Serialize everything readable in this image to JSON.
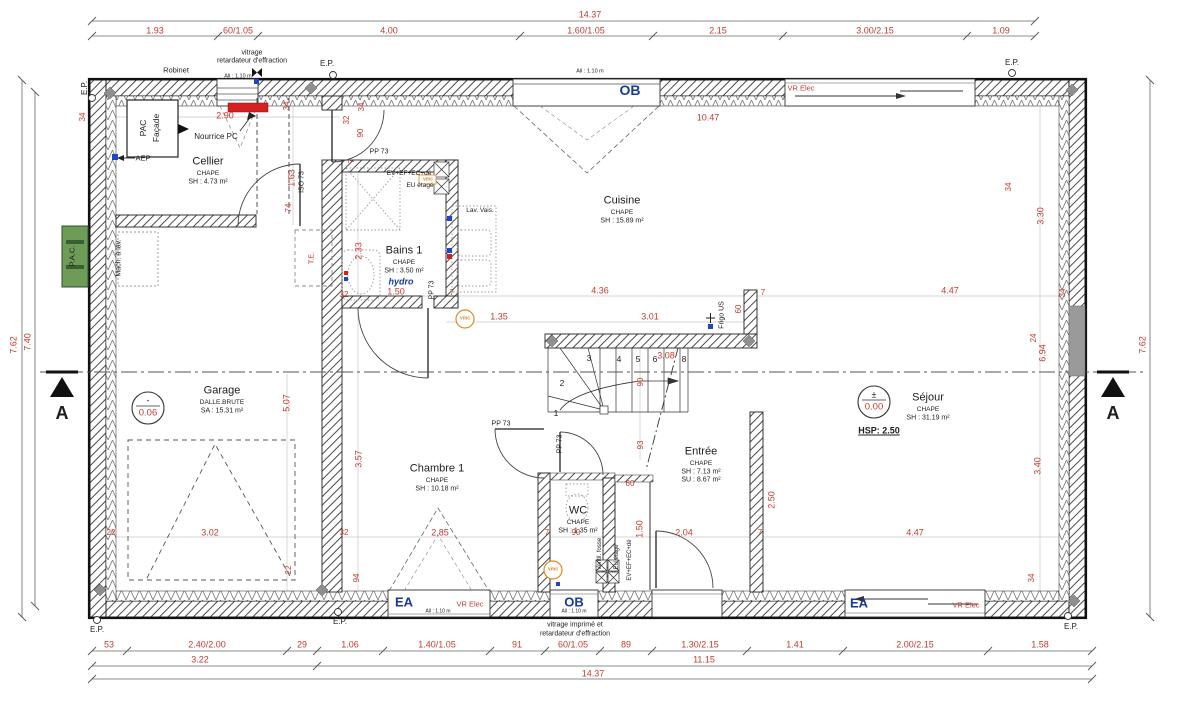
{
  "drawing_type": "floor-plan",
  "colors": {
    "dimension_red": "#c43a30",
    "window_label_blue": "#16399c",
    "vmc_orange": "#e0891e",
    "pac_green": "#6d9c57",
    "nourrice_red_fill": "#d42020",
    "wall_black": "#1d1d1d",
    "concrete_gray": "#9a9a9a"
  },
  "rooms": [
    {
      "name": "Cellier",
      "finish": "CHAPE",
      "area": "SH : 4.73 m²",
      "x": 208,
      "y": 162
    },
    {
      "name": "Bains 1",
      "finish": "CHAPE",
      "area": "SH : 3.50 m²",
      "extra": "hydro",
      "x": 404,
      "y": 251
    },
    {
      "name": "Cuisine",
      "finish": "CHAPE",
      "area": "SH : 15.89 m²",
      "x": 622,
      "y": 201
    },
    {
      "name": "Garage",
      "finish": "DALLE.BRUTE",
      "area": "SA : 15.31 m²",
      "x": 222,
      "y": 391
    },
    {
      "name": "Chambre 1",
      "finish": "CHAPE",
      "area": "SH : 10.18 m²",
      "x": 437,
      "y": 469
    },
    {
      "name": "WC",
      "finish": "CHAPE",
      "area": "SH : 1.35 m²",
      "x": 578,
      "y": 511
    },
    {
      "name": "Entrée",
      "finish": "CHAPE",
      "area": "SH : 7.13 m²",
      "area2": "SU : 8.67 m²",
      "x": 701,
      "y": 452
    },
    {
      "name": "Séjour",
      "finish": "CHAPE",
      "area": "SH : 31.19 m²",
      "x": 928,
      "y": 398
    }
  ],
  "levels": [
    {
      "room": "Garage",
      "sign": "-",
      "value": "0.06"
    },
    {
      "room": "Séjour",
      "sign": "±",
      "value": "0.00"
    }
  ],
  "height_note": "HSP: 2.50",
  "section_marker": "A",
  "stair_numbers": [
    "1",
    "2",
    "3",
    "4",
    "5",
    "6",
    "8"
  ],
  "dim_chains": {
    "h": [
      {
        "y": 21,
        "x": [
          92,
          1035
        ]
      },
      {
        "y": 36,
        "x": [
          92,
          218,
          258,
          520,
          653,
          783,
          967,
          1035
        ]
      },
      {
        "y": 651,
        "x": [
          92,
          127,
          287,
          317,
          383,
          490,
          545,
          600,
          652,
          747,
          843,
          988,
          1092
        ]
      },
      {
        "y": 666,
        "x": [
          92,
          317,
          1092
        ]
      },
      {
        "y": 679,
        "x": [
          92,
          1092
        ]
      }
    ],
    "v": [
      {
        "x": 22,
        "y": [
          80,
          617
        ]
      },
      {
        "x": 35,
        "y": [
          92,
          606
        ]
      },
      {
        "x": 1150,
        "y": [
          80,
          617
        ]
      }
    ]
  },
  "annotations": [
    {
      "t": "14.37",
      "x": 590,
      "y": 15,
      "n": "dim-top-total"
    },
    {
      "t": "1.93",
      "x": 155,
      "y": 31
    },
    {
      "t": "60/1.05",
      "x": 238,
      "y": 31
    },
    {
      "t": "4.00",
      "x": 389,
      "y": 31
    },
    {
      "t": "1.60/1.05",
      "x": 586,
      "y": 31
    },
    {
      "t": "2.15",
      "x": 718,
      "y": 31
    },
    {
      "t": "3.00/2.15",
      "x": 875,
      "y": 31
    },
    {
      "t": "1.09",
      "x": 1001,
      "y": 31
    },
    {
      "t": "53",
      "x": 109,
      "y": 645
    },
    {
      "t": "2.40/2.00",
      "x": 207,
      "y": 645
    },
    {
      "t": "29",
      "x": 302,
      "y": 645
    },
    {
      "t": "1.06",
      "x": 350,
      "y": 645
    },
    {
      "t": "1.40/1.05",
      "x": 437,
      "y": 645
    },
    {
      "t": "91",
      "x": 517,
      "y": 645
    },
    {
      "t": "60/1.05",
      "x": 573,
      "y": 645
    },
    {
      "t": "89",
      "x": 626,
      "y": 645
    },
    {
      "t": "1.30/2.15",
      "x": 700,
      "y": 645
    },
    {
      "t": "1.41",
      "x": 795,
      "y": 645
    },
    {
      "t": "2.00/2.15",
      "x": 915,
      "y": 645
    },
    {
      "t": "1.58",
      "x": 1040,
      "y": 645
    },
    {
      "t": "3.22",
      "x": 200,
      "y": 660
    },
    {
      "t": "11.15",
      "x": 704,
      "y": 660
    },
    {
      "t": "14.37",
      "x": 593,
      "y": 674,
      "n": "dim-bottom-total"
    },
    {
      "t": "7.62",
      "x": 14,
      "y": 345,
      "r": -90
    },
    {
      "t": "7.40",
      "x": 28,
      "y": 342,
      "r": -90
    },
    {
      "t": "7.62",
      "x": 1143,
      "y": 345,
      "r": -90
    },
    {
      "t": "2.90",
      "x": 225,
      "y": 116
    },
    {
      "t": "34",
      "x": 83,
      "y": 117,
      "r": -90,
      "s": 8
    },
    {
      "t": "34",
      "x": 287,
      "y": 106,
      "r": -90,
      "s": 8
    },
    {
      "t": "32",
      "x": 347,
      "y": 120,
      "r": -90,
      "s": 8
    },
    {
      "t": "34",
      "x": 362,
      "y": 107,
      "r": -90,
      "s": 8
    },
    {
      "t": "90",
      "x": 361,
      "y": 133,
      "r": -90,
      "s": 8
    },
    {
      "t": "1.63",
      "x": 292,
      "y": 178,
      "r": -90
    },
    {
      "t": "74",
      "x": 289,
      "y": 208,
      "r": -90,
      "s": 8
    },
    {
      "t": "10.47",
      "x": 708,
      "y": 118
    },
    {
      "t": "3.30",
      "x": 1041,
      "y": 216,
      "r": -90
    },
    {
      "t": "2.33",
      "x": 359,
      "y": 251,
      "r": -90
    },
    {
      "t": "7",
      "x": 352,
      "y": 161,
      "r": -90,
      "s": 8
    },
    {
      "t": "32",
      "x": 344,
      "y": 295,
      "s": 8
    },
    {
      "t": "1.50",
      "x": 396,
      "y": 292
    },
    {
      "t": "7",
      "x": 452,
      "y": 293,
      "s": 8
    },
    {
      "t": "4.36",
      "x": 600,
      "y": 291
    },
    {
      "t": "7",
      "x": 763,
      "y": 293,
      "s": 8
    },
    {
      "t": "4.47",
      "x": 950,
      "y": 291
    },
    {
      "t": "34",
      "x": 1063,
      "y": 293,
      "r": -90,
      "s": 8
    },
    {
      "t": "34",
      "x": 1009,
      "y": 187,
      "r": -90,
      "s": 8
    },
    {
      "t": "1.35",
      "x": 499,
      "y": 317
    },
    {
      "t": "3.01",
      "x": 650,
      "y": 317
    },
    {
      "t": "60",
      "x": 739,
      "y": 309,
      "r": -90,
      "s": 8
    },
    {
      "t": "24",
      "x": 1034,
      "y": 338,
      "r": -90,
      "s": 8
    },
    {
      "t": "6.94",
      "x": 1043,
      "y": 353,
      "r": -90
    },
    {
      "t": "3.08",
      "x": 666,
      "y": 356
    },
    {
      "t": "90",
      "x": 641,
      "y": 382,
      "r": -90,
      "s": 8
    },
    {
      "t": "93",
      "x": 641,
      "y": 445,
      "r": -90,
      "s": 8
    },
    {
      "t": "5.07",
      "x": 287,
      "y": 403,
      "r": -90
    },
    {
      "t": "3.57",
      "x": 359,
      "y": 459,
      "r": -90
    },
    {
      "t": "3.02",
      "x": 210,
      "y": 533
    },
    {
      "t": "22",
      "x": 111,
      "y": 533,
      "s": 8
    },
    {
      "t": "22",
      "x": 289,
      "y": 570,
      "r": -90,
      "s": 8
    },
    {
      "t": "32",
      "x": 344,
      "y": 533,
      "s": 8
    },
    {
      "t": "2.85",
      "x": 440,
      "y": 533
    },
    {
      "t": "7",
      "x": 547,
      "y": 533,
      "s": 8
    },
    {
      "t": "90",
      "x": 576,
      "y": 533,
      "s": 8
    },
    {
      "t": "60",
      "x": 630,
      "y": 484,
      "s": 8
    },
    {
      "t": "1.50",
      "x": 640,
      "y": 529,
      "r": -90
    },
    {
      "t": "2.04",
      "x": 684,
      "y": 533
    },
    {
      "t": "7",
      "x": 760,
      "y": 533,
      "s": 8
    },
    {
      "t": "2.50",
      "x": 772,
      "y": 500,
      "r": -90
    },
    {
      "t": "4.47",
      "x": 915,
      "y": 533
    },
    {
      "t": "3.40",
      "x": 1038,
      "y": 466,
      "r": -90
    },
    {
      "t": "34",
      "x": 1032,
      "y": 578,
      "r": -90,
      "s": 8
    },
    {
      "t": "94",
      "x": 357,
      "y": 578,
      "r": -90,
      "s": 8
    },
    {
      "t": "VR Elec",
      "x": 801,
      "y": 88,
      "s": 7.5,
      "n": "vr-elec-label"
    },
    {
      "t": "VR Elec",
      "x": 470,
      "y": 604,
      "s": 7.5,
      "n": "vr-elec-label"
    },
    {
      "t": "VR Elec",
      "x": 966,
      "y": 605,
      "s": 7.5,
      "n": "vr-elec-label"
    },
    {
      "t": "T.E.",
      "x": 312,
      "y": 258,
      "r": -90,
      "s": 7,
      "n": "te-label"
    },
    {
      "t": "Robinet",
      "x": 176,
      "y": 70,
      "s": 7.5,
      "c": "blk",
      "n": "robinet-label"
    },
    {
      "t": "vitrage",
      "x": 252,
      "y": 53,
      "s": 7,
      "c": "blk",
      "n": "glazing-note"
    },
    {
      "t": "retardateur d'effraction",
      "x": 252,
      "y": 61,
      "s": 7,
      "c": "blk",
      "n": "glazing-note"
    },
    {
      "t": "All : 1.10 m",
      "x": 238,
      "y": 77,
      "s": 5.5,
      "c": "blk"
    },
    {
      "t": "All : 1.10 m",
      "x": 590,
      "y": 72,
      "s": 5.5,
      "c": "blk"
    },
    {
      "t": "All : 1.10 m",
      "x": 438,
      "y": 612,
      "s": 5,
      "c": "blk"
    },
    {
      "t": "All : 1.10 m",
      "x": 574,
      "y": 612,
      "s": 5,
      "c": "blk"
    },
    {
      "t": "E.P.",
      "x": 85,
      "y": 88,
      "r": -90,
      "c": "blk",
      "s": 8,
      "n": "ep-marker"
    },
    {
      "t": "E.P.",
      "x": 327,
      "y": 64,
      "c": "blk",
      "s": 8,
      "n": "ep-marker"
    },
    {
      "t": "E.P.",
      "x": 1012,
      "y": 63,
      "c": "blk",
      "s": 8,
      "n": "ep-marker"
    },
    {
      "t": "E.P.",
      "x": 97,
      "y": 630,
      "c": "blk",
      "s": 8,
      "n": "ep-marker"
    },
    {
      "t": "E.P.",
      "x": 340,
      "y": 622,
      "c": "blk",
      "s": 8,
      "n": "ep-marker"
    },
    {
      "t": "E.P.",
      "x": 1071,
      "y": 627,
      "c": "blk",
      "s": 8,
      "n": "ep-marker"
    },
    {
      "t": "PAC",
      "x": 143,
      "y": 128,
      "r": -90,
      "c": "blk",
      "s": 8.5,
      "n": "pac-facade-label"
    },
    {
      "t": "Façade",
      "x": 156,
      "y": 128,
      "r": -90,
      "c": "blk",
      "s": 8.5,
      "n": "pac-facade-label"
    },
    {
      "t": "Nourrice PC",
      "x": 216,
      "y": 137,
      "c": "blk",
      "s": 8,
      "n": "nourrice-label"
    },
    {
      "t": "AEP",
      "x": 143,
      "y": 158,
      "c": "blk",
      "s": 7.5,
      "n": "aep-label"
    },
    {
      "t": "Mach. à lav.",
      "x": 119,
      "y": 258,
      "r": -90,
      "c": "blk",
      "s": 7,
      "n": "washing-machine-label"
    },
    {
      "t": "ISO 73",
      "x": 302,
      "y": 182,
      "r": -90,
      "c": "blk",
      "s": 7,
      "n": "door-tag"
    },
    {
      "t": "PP 73",
      "x": 379,
      "y": 152,
      "c": "blk",
      "s": 7,
      "n": "door-tag"
    },
    {
      "t": "PP 73",
      "x": 432,
      "y": 290,
      "r": -90,
      "c": "blk",
      "s": 7,
      "n": "door-tag"
    },
    {
      "t": "PP 73",
      "x": 501,
      "y": 424,
      "c": "blk",
      "s": 7,
      "n": "door-tag"
    },
    {
      "t": "PP 73",
      "x": 560,
      "y": 444,
      "r": -90,
      "c": "blk",
      "s": 7,
      "n": "door-tag"
    },
    {
      "t": "EV+EF+EC+dé",
      "x": 409,
      "y": 174,
      "c": "blk",
      "s": 6.5,
      "n": "plumbing-riser-label"
    },
    {
      "t": "EU étagé",
      "x": 420,
      "y": 186,
      "c": "blk",
      "s": 6.5,
      "n": "plumbing-riser-label"
    },
    {
      "t": "Lav. Vais.",
      "x": 480,
      "y": 211,
      "c": "blk",
      "s": 6.5,
      "n": "sink-label"
    },
    {
      "t": "Frigo US",
      "x": 722,
      "y": 315,
      "r": -90,
      "c": "blk",
      "s": 7,
      "n": "fridge-label"
    },
    {
      "t": "Ventil. fosse",
      "x": 600,
      "y": 554,
      "r": -90,
      "c": "blk",
      "s": 6,
      "n": "duct-label"
    },
    {
      "t": "EU étagé",
      "x": 617,
      "y": 557,
      "r": -90,
      "c": "blk",
      "s": 6,
      "n": "duct-label"
    },
    {
      "t": "EV+EF+EC+dé",
      "x": 630,
      "y": 560,
      "r": -90,
      "c": "blk",
      "s": 6,
      "n": "duct-label"
    },
    {
      "t": "vitrage imprimé et",
      "x": 575,
      "y": 625,
      "c": "blk",
      "s": 7,
      "n": "glazing-note"
    },
    {
      "t": "retardateur d'effraction",
      "x": 575,
      "y": 634,
      "c": "blk",
      "s": 7,
      "n": "glazing-note"
    },
    {
      "t": "HSP: 2.50",
      "x": 879,
      "y": 431,
      "c": "blk",
      "s": 9,
      "b": 1,
      "u": 1,
      "n": "ceiling-height-note"
    },
    {
      "t": "-",
      "x": 148,
      "y": 401,
      "c": "blk",
      "s": 9,
      "n": "level-sign"
    },
    {
      "t": "0.06",
      "x": 148,
      "y": 413,
      "s": 9.5,
      "n": "level-value"
    },
    {
      "t": "±",
      "x": 874,
      "y": 395,
      "c": "blk",
      "s": 9,
      "n": "level-sign"
    },
    {
      "t": "0.00",
      "x": 874,
      "y": 407,
      "s": 9.5,
      "n": "level-value"
    },
    {
      "t": "A",
      "x": 62,
      "y": 413,
      "c": "blk",
      "s": 18,
      "b": 1,
      "n": "section-letter"
    },
    {
      "t": "A",
      "x": 1113,
      "y": 413,
      "c": "blk",
      "s": 18,
      "b": 1,
      "n": "section-letter"
    },
    {
      "t": "P.A.C.",
      "x": 72,
      "y": 256,
      "r": -90,
      "c": "blk",
      "s": 7.5,
      "n": "pac-unit-label"
    },
    {
      "t": "OB",
      "x": 630,
      "y": 90,
      "c": "blue",
      "s": 14,
      "n": "window-tag-ob"
    },
    {
      "t": "OB",
      "x": 574,
      "y": 602,
      "c": "blue",
      "s": 13,
      "n": "window-tag-ob"
    },
    {
      "t": "EA",
      "x": 404,
      "y": 602,
      "c": "blue",
      "s": 13,
      "n": "window-tag-ea"
    },
    {
      "t": "EA",
      "x": 859,
      "y": 603,
      "c": "blue",
      "s": 13,
      "n": "window-tag-ea"
    },
    {
      "t": "hydro",
      "x": 401,
      "y": 282,
      "c": "blue",
      "s": 9,
      "i": 1,
      "n": "hydro-label"
    },
    {
      "t": "vmc",
      "x": 465,
      "y": 319,
      "c": "orange",
      "s": 5,
      "n": "vmc-label"
    },
    {
      "t": "vmc",
      "x": 553,
      "y": 570,
      "c": "orange",
      "s": 5,
      "n": "vmc-label"
    },
    {
      "t": "vmc",
      "x": 428,
      "y": 180,
      "c": "orange",
      "s": 5,
      "n": "vmc-label"
    },
    {
      "t": "1",
      "x": 556,
      "y": 413,
      "c": "blk",
      "s": 8.5,
      "n": "stair-number"
    },
    {
      "t": "2",
      "x": 562,
      "y": 383,
      "c": "blk",
      "s": 8.5,
      "n": "stair-number"
    },
    {
      "t": "3",
      "x": 589,
      "y": 358,
      "c": "blk",
      "s": 8.5,
      "n": "stair-number"
    },
    {
      "t": "4",
      "x": 619,
      "y": 359,
      "c": "blk",
      "s": 8.5,
      "n": "stair-number"
    },
    {
      "t": "5",
      "x": 638,
      "y": 359,
      "c": "blk",
      "s": 8.5,
      "n": "stair-number"
    },
    {
      "t": "6",
      "x": 655,
      "y": 359,
      "c": "blk",
      "s": 8.5,
      "n": "stair-number"
    },
    {
      "t": "8",
      "x": 684,
      "y": 359,
      "c": "blk",
      "s": 8.5,
      "n": "stair-number"
    }
  ]
}
